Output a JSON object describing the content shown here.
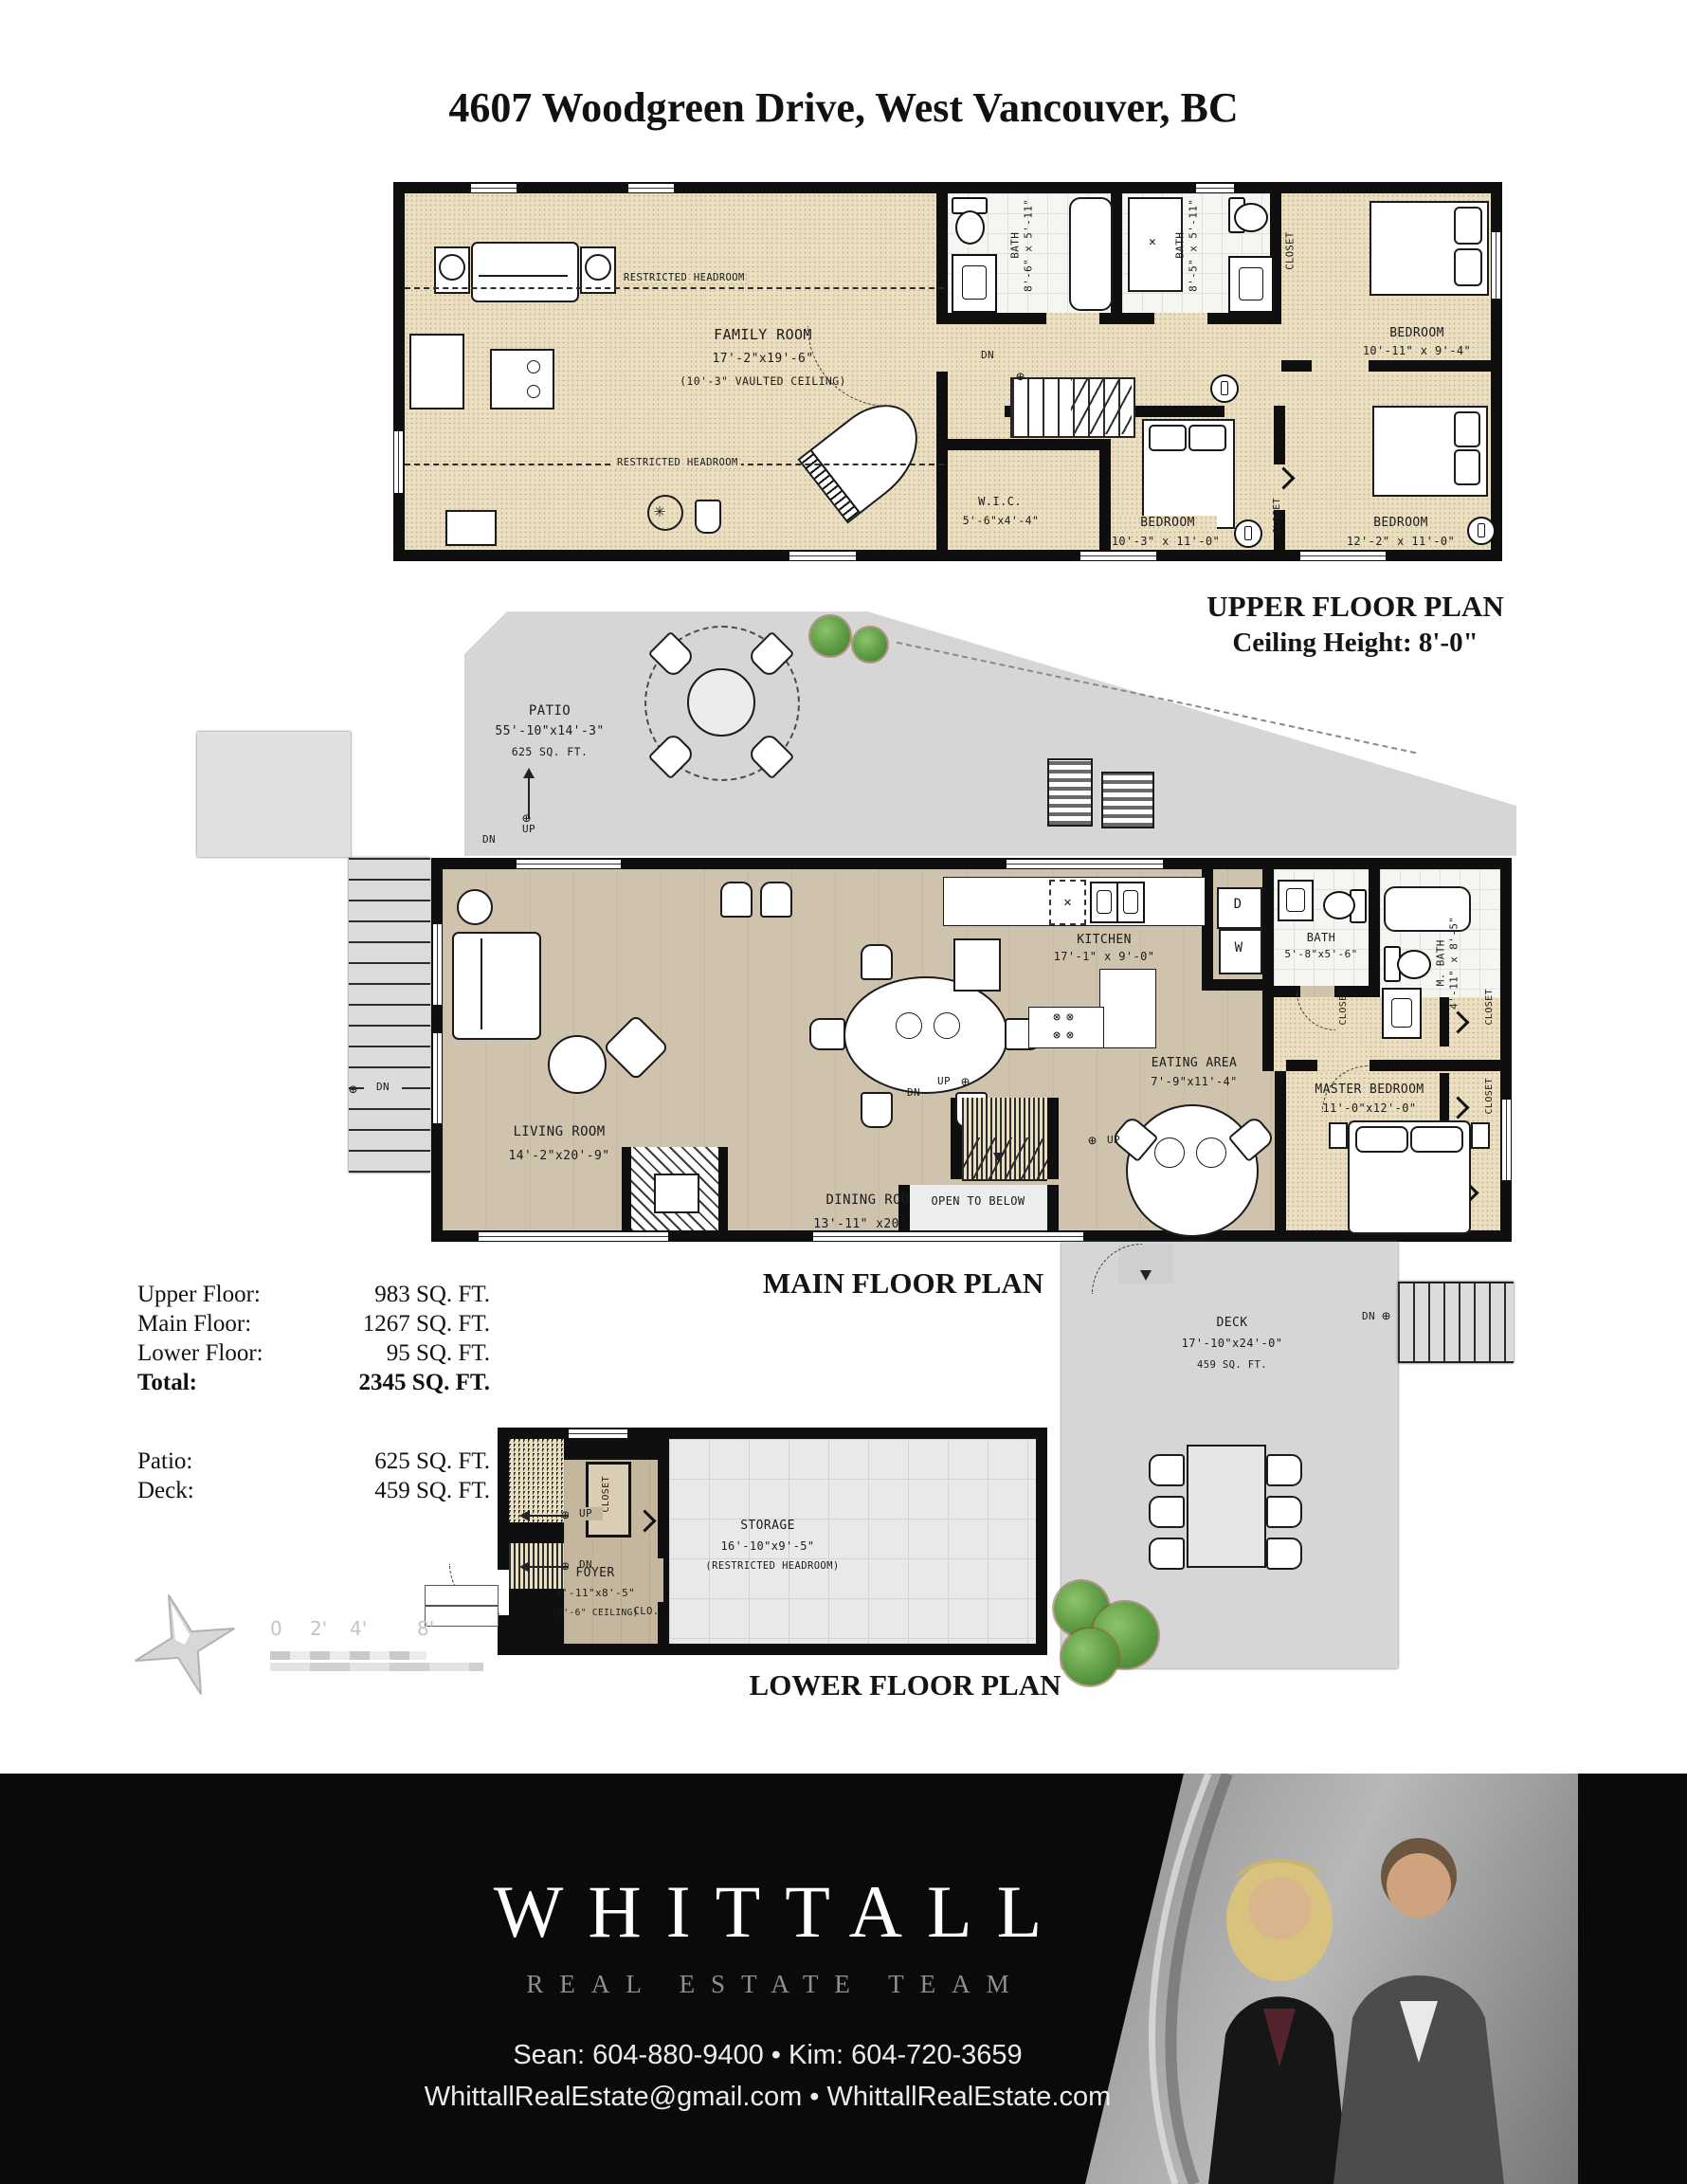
{
  "title": "4607 Woodgreen Drive, West Vancouver, BC",
  "upper_plan": {
    "caption": "UPPER FLOOR PLAN",
    "ceiling": "Ceiling Height: 8'-0\"",
    "family_room": {
      "name": "FAMILY ROOM",
      "dims": "17'-2\"x19'-6\"",
      "note": "(10'-3\" VAULTED CEILING)"
    },
    "restricted_headroom": "RESTRICTED HEADROOM",
    "bath1": {
      "name": "BATH",
      "dims": "8'-6\" x 5'-11\""
    },
    "bath2": {
      "name": "BATH",
      "dims": "8'-5\" x 5'-11\""
    },
    "closet": "CLOSET",
    "bedroom1": {
      "name": "BEDROOM",
      "dims": "10'-11\" x 9'-4\""
    },
    "bedroom2": {
      "name": "BEDROOM",
      "dims": "10'-3\" x 11'-0\""
    },
    "bedroom3": {
      "name": "BEDROOM",
      "dims": "12'-2\" x 11'-0\""
    },
    "wic": {
      "name": "W.I.C.",
      "dims": "5'-6\"x4'-4\""
    },
    "dn": "DN"
  },
  "main_plan": {
    "caption": "MAIN FLOOR PLAN",
    "patio": {
      "name": "PATIO",
      "dims": "55'-10\"x14'-3\"",
      "sqft": "625 SQ. FT."
    },
    "kitchen": {
      "name": "KITCHEN",
      "dims": "17'-1\" x 9'-0\""
    },
    "bath": {
      "name": "BATH",
      "dims": "5'-8\"x5'-6\""
    },
    "mbath": {
      "name": "M. BATH",
      "dims": "4'-11\" x 8'-5\""
    },
    "eating": {
      "name": "EATING AREA",
      "dims": "7'-9\"x11'-4\""
    },
    "master": {
      "name": "MASTER BEDROOM",
      "dims": "11'-0\"x12'-0\""
    },
    "living": {
      "name": "LIVING ROOM",
      "dims": "14'-2\"x20'-9\""
    },
    "dining": {
      "name": "DINING ROOM",
      "dims": "13'-11\" x20'-9\""
    },
    "open_below": "OPEN TO BELOW",
    "closet": "CLOSET",
    "up": "UP",
    "dn": "DN",
    "dryer": "D",
    "washer": "W",
    "deck": {
      "name": "DECK",
      "dims": "17'-10\"x24'-0\"",
      "sqft": "459 SQ. FT."
    }
  },
  "lower_plan": {
    "caption": "LOWER FLOOR PLAN",
    "foyer": {
      "name": "FOYER",
      "dims": "4'-11\"x8'-5\"",
      "note": "(9'-6\" CEILING)"
    },
    "clo": "CLO.",
    "closet": "CLOSET",
    "storage": {
      "name": "STORAGE",
      "dims": "16'-10\"x9'-5\"",
      "note": "(RESTRICTED HEADROOM)"
    },
    "up": "UP",
    "dn": "DN"
  },
  "areas": {
    "rows": [
      {
        "label": "Upper Floor:",
        "value": "983 SQ. FT."
      },
      {
        "label": "Main Floor:",
        "value": "1267 SQ. FT."
      },
      {
        "label": "Lower Floor:",
        "value": "95 SQ. FT."
      },
      {
        "label": "Total:",
        "value": "2345 SQ. FT."
      }
    ],
    "rows2": [
      {
        "label": "Patio:",
        "value": "625 SQ. FT."
      },
      {
        "label": "Deck:",
        "value": "459 SQ. FT."
      }
    ]
  },
  "scale_bar": {
    "labels": [
      "0",
      "2'",
      "4'",
      "8'"
    ]
  },
  "footer": {
    "brand": "WHITTALL",
    "tagline": "REAL ESTATE TEAM",
    "phones": "Sean: 604-880-9400 • Kim: 604-720-3659",
    "web": "WhittallRealEstate@gmail.com • WhittallRealEstate.com"
  }
}
